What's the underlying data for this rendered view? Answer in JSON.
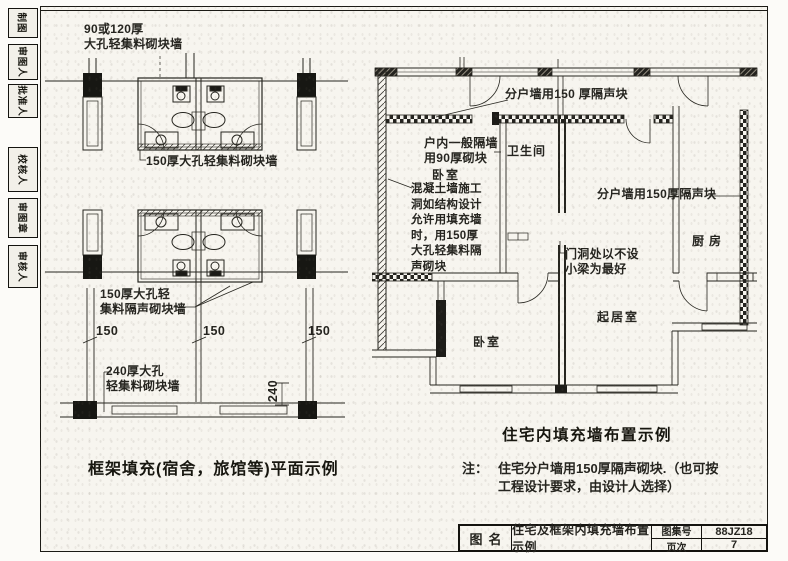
{
  "sidebar": {
    "tabs": [
      {
        "label": "制图"
      },
      {
        "label": "审图人"
      },
      {
        "label": "批准人"
      },
      {
        "label": "校核人"
      },
      {
        "label": "审图章"
      },
      {
        "label": "审核人"
      }
    ]
  },
  "left_plan": {
    "annotations": {
      "wall_90_120": "90或120厚\n大孔轻集料砌块墙",
      "wall_150": "150厚大孔轻集料砌块墙",
      "wall_150_sound": "150厚大孔轻\n集料隔声砌块墙",
      "wall_240": "240厚大孔\n轻集料砌块墙"
    },
    "dimensions": {
      "d1": "150",
      "d2": "150",
      "d3": "150",
      "d4": "240"
    },
    "caption": "框架填充(宿舍，旅馆等)平面示例"
  },
  "right_plan": {
    "annotations": {
      "party_wall_top": "分户墙用150 厚隔声块",
      "partition_90": "户内一般隔墙\n用90厚砌块",
      "concrete_hole": "混凝土墙施工\n洞如结构设计\n允许用填充墙\n时，用150厚\n大孔轻集料隔\n声砌块",
      "party_wall_right": "分户墙用150厚隔声块",
      "door_opening": "门洞处以不设\n小梁为最好"
    },
    "rooms": {
      "bedroom1": "卧室",
      "bathroom": "卫生间",
      "kitchen": "厨房",
      "living": "起居室",
      "bedroom2": "卧室"
    },
    "caption": "住宅内填充墙布置示例",
    "note": {
      "prefix": "注：",
      "line1": "住宅分户墙用150厚隔声砌块.（也可按",
      "line2": "工程设计要求，由设计人选择）"
    }
  },
  "title_block": {
    "name_label": "图名",
    "name_value": "住宅及框架内填充墙布置示例",
    "atlas_label": "图集号",
    "atlas_value": "88JZ18",
    "page_label": "页次",
    "page_value": "7"
  }
}
